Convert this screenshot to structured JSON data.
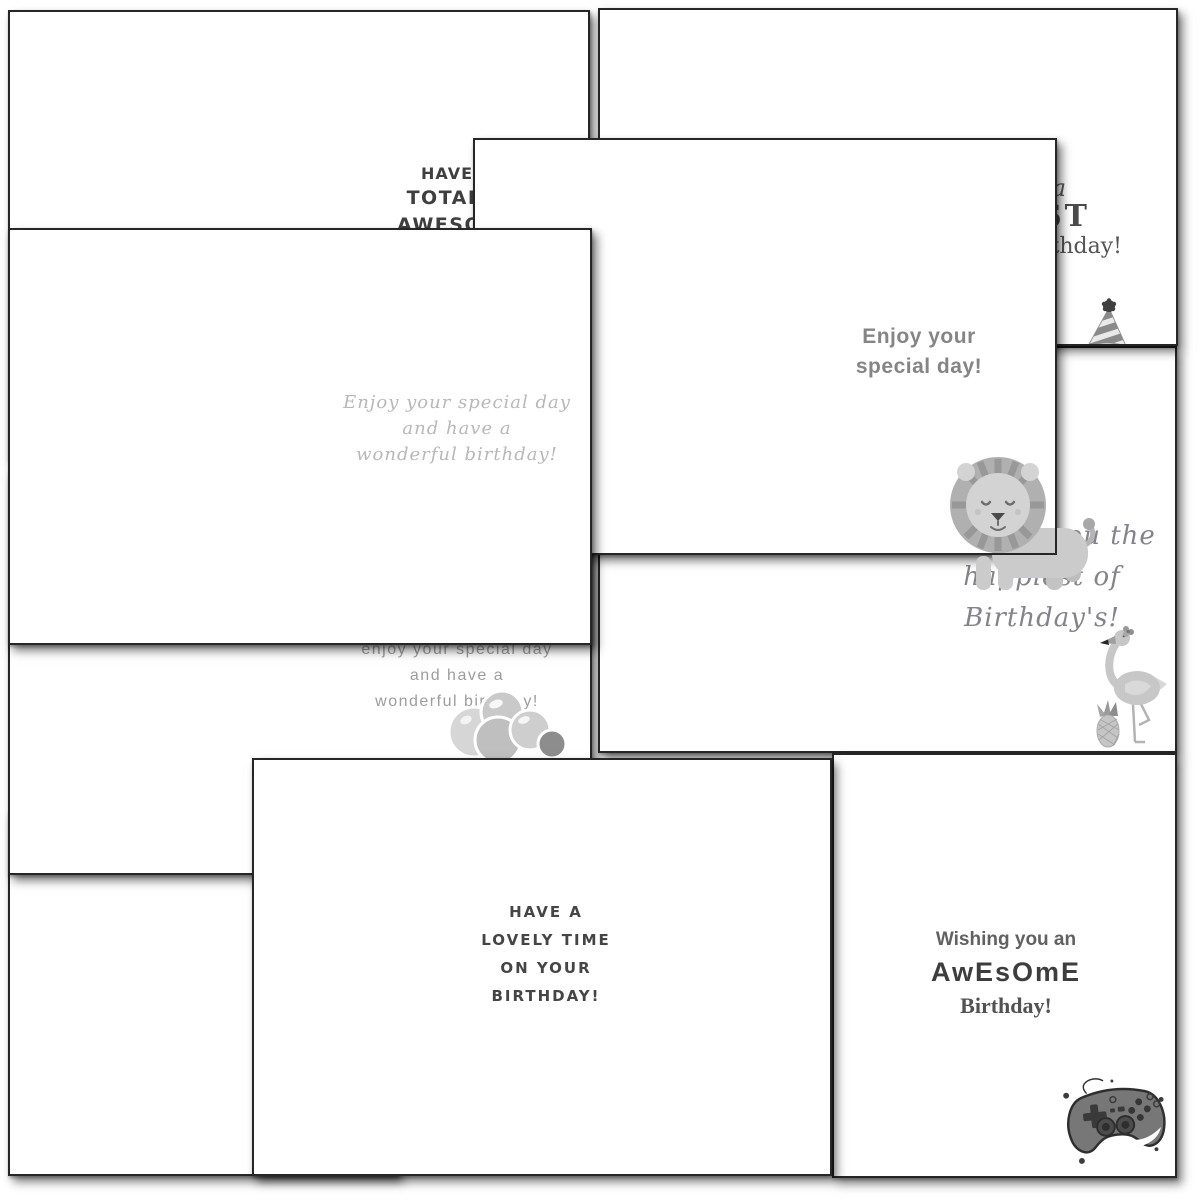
{
  "cards": {
    "top_left": {
      "lines": [
        "HAVE A",
        "TOTALLY",
        "AWESOME"
      ]
    },
    "top_right": {
      "lines": [
        "Have a",
        "BLAST",
        "on your birthday!"
      ]
    },
    "special_day": {
      "lines": [
        "Enjoy your",
        "special day!"
      ]
    },
    "script_card": {
      "lines": [
        "Enjoy your special day",
        "and have a",
        "wonderful birthday!"
      ]
    },
    "flamingo_card": {
      "lines": [
        "Wishing you the",
        "happiest of",
        "Birthday's!"
      ]
    },
    "balloons_card": {
      "lines": [
        "enjoy your special day",
        "and have a",
        "wonderful birthday!"
      ]
    },
    "lovely_card": {
      "lines": [
        "HAVE A",
        "LOVELY TIME",
        "ON YOUR",
        "BIRTHDAY!"
      ]
    },
    "awesome_card": {
      "lines": [
        "Wishing you an",
        "AwEsOmE",
        "Birthday!"
      ]
    }
  },
  "icons": {
    "party_hat": "party-hat-icon",
    "lion": "lion-icon",
    "flamingo": "flamingo-icon",
    "pineapple": "pineapple-icon",
    "balloons": "balloons-icon",
    "game_controller": "game-controller-icon"
  },
  "colors": {
    "card_background": "#ffffff",
    "card_border": "#262626",
    "text_dark": "#3f3f3f",
    "text_mid": "#5a5a5a",
    "text_gray": "#858585",
    "text_light_script": "#b8b8b8",
    "script_gray": "#83838b",
    "illustration_gray": "#c7c7c7",
    "illustration_dark": "#777777"
  }
}
